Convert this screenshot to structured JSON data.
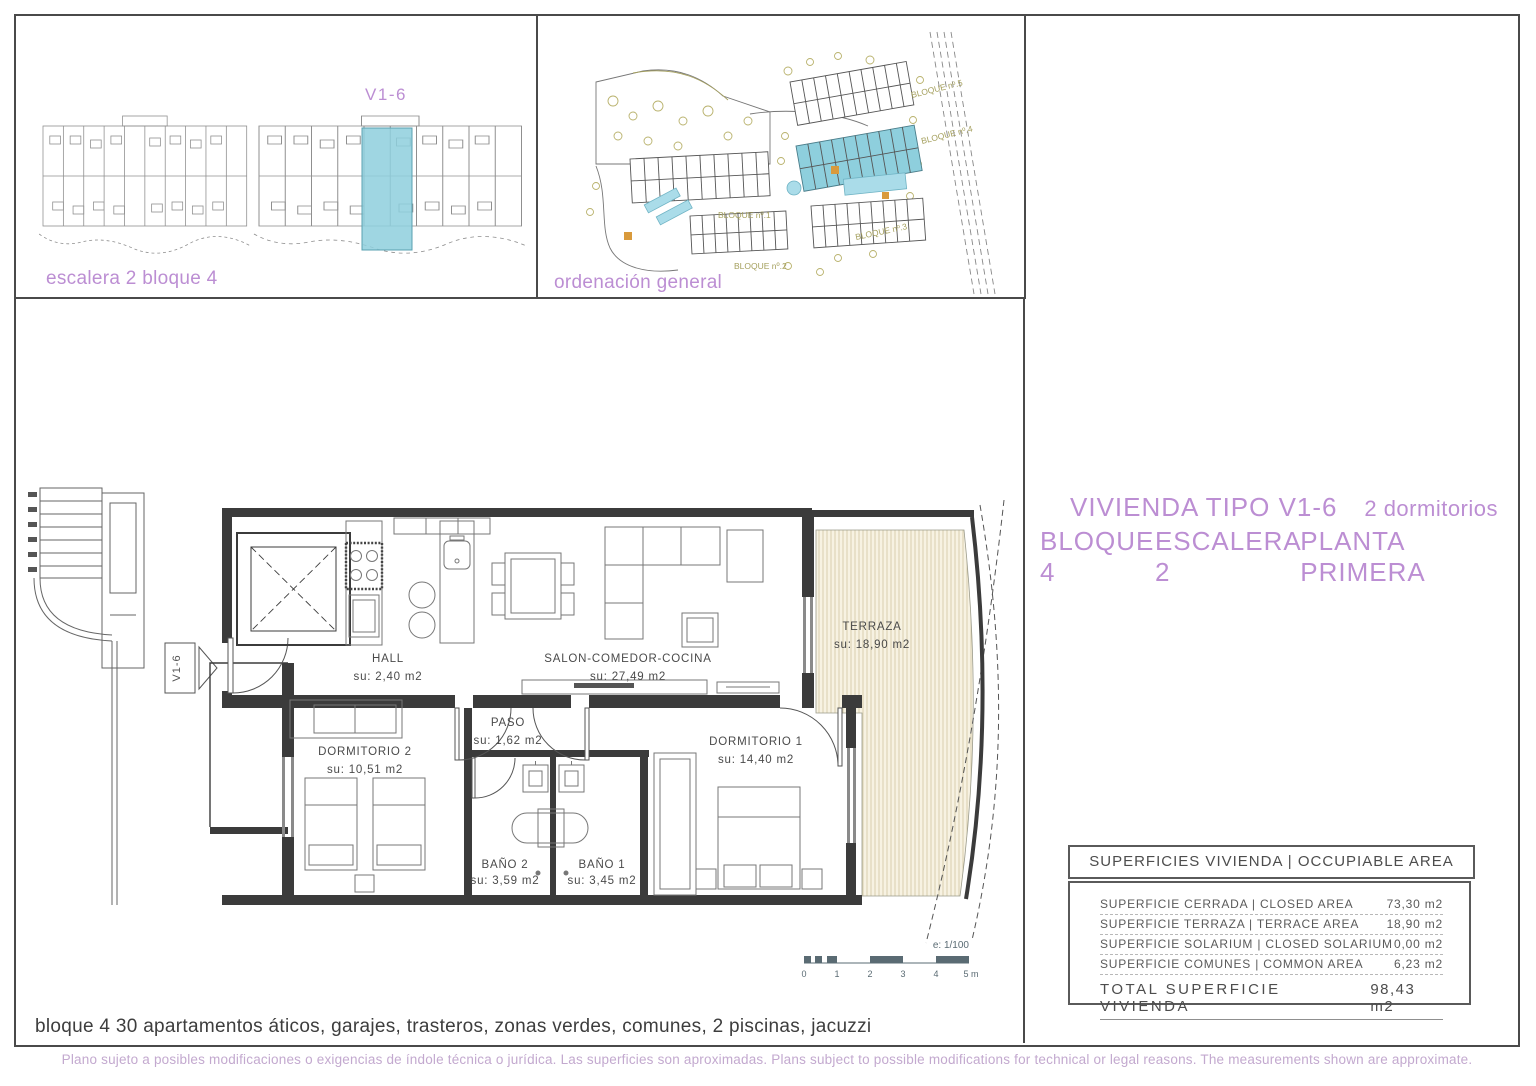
{
  "colors": {
    "accent_purple": "#bc8ed3",
    "highlight_blue": "#8ecfdd",
    "terrace_cream": "#f7f2e2",
    "site_olive": "#a5a05e",
    "line_dark": "#3b3b3b"
  },
  "panel_escalera": {
    "unit_label": "V1-6",
    "caption": "escalera 2 bloque 4"
  },
  "panel_ordenacion": {
    "caption": "ordenación general",
    "blocks": [
      {
        "label": "BLOQUE nº.5"
      },
      {
        "label": "BLOQUE nº.4"
      },
      {
        "label": "BLOQUE nº.1"
      },
      {
        "label": "BLOQUE nº.2"
      },
      {
        "label": "BLOQUE nº.3"
      }
    ]
  },
  "title": {
    "line1_left": "VIVIENDA TIPO V1-6",
    "line1_right": "2 dormitorios",
    "line2_parts": [
      "BLOQUE 4",
      "ESCALERA 2",
      "PLANTA PRIMERA"
    ]
  },
  "plan": {
    "marker": "V1-6",
    "rooms": [
      {
        "name": "HALL",
        "su": "su: 2,40 m2"
      },
      {
        "name": "SALON-COMEDOR-COCINA",
        "su": "su: 27,49 m2"
      },
      {
        "name": "PASO",
        "su": "su: 1,62 m2"
      },
      {
        "name": "DORMITORIO 2",
        "su": "su: 10,51 m2"
      },
      {
        "name": "DORMITORIO 1",
        "su": "su: 14,40 m2"
      },
      {
        "name": "BAÑO 2",
        "su": "su: 3,59 m2"
      },
      {
        "name": "BAÑO 1",
        "su": "su: 3,45 m2"
      },
      {
        "name": "TERRAZA",
        "su": "su: 18,90 m2"
      }
    ],
    "scale": {
      "label": "e: 1/100",
      "ticks": [
        "0",
        "1",
        "2",
        "3",
        "4",
        "5 m"
      ]
    }
  },
  "areas_table": {
    "header": "SUPERFICIES VIVIENDA | OCCUPIABLE AREA",
    "rows": [
      {
        "label": "SUPERFICIE CERRADA | CLOSED AREA",
        "value": "73,30 m2"
      },
      {
        "label": "SUPERFICIE TERRAZA | TERRACE AREA",
        "value": "18,90 m2"
      },
      {
        "label": "SUPERFICIE SOLARIUM | CLOSED SOLARIUM",
        "value": "0,00 m2"
      },
      {
        "label": "SUPERFICIE COMUNES | COMMON AREA",
        "value": "6,23 m2"
      }
    ],
    "total_label": "TOTAL SUPERFICIE VIVIENDA",
    "total_value": "98,43 m2"
  },
  "caption": "bloque 4 30 apartamentos áticos, garajes, trasteros, zonas verdes, comunes, 2 piscinas, jacuzzi",
  "footer": "Plano sujeto a posibles modificaciones o exigencias de índole técnica o jurídica. Las superficies son aproximadas. Plans subject to possible modifications for technical or legal reasons. The measurements shown are approximate."
}
